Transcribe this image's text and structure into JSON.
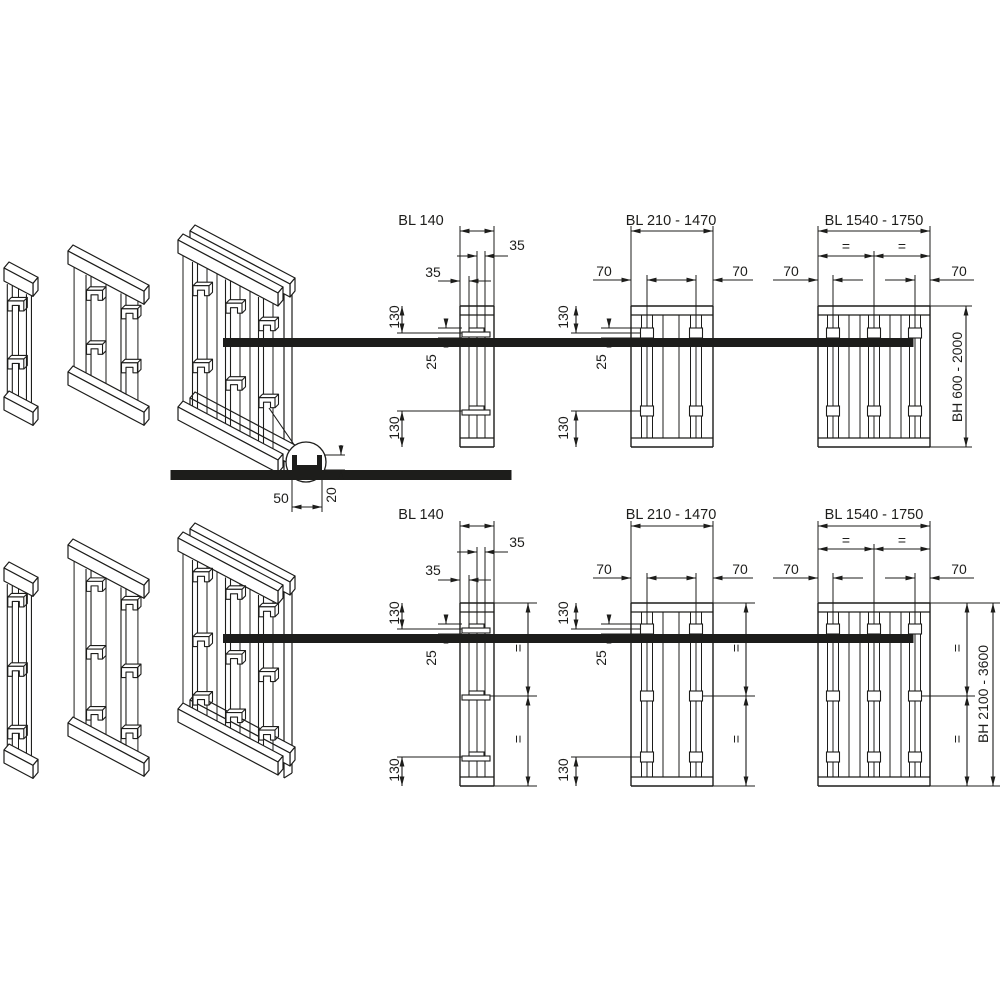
{
  "colors": {
    "line": "#1d1d1b",
    "background": "#ffffff"
  },
  "detail_callout": {
    "dim_width": "50",
    "dim_height": "20"
  },
  "rows": {
    "top": {
      "bl140": {
        "title": "BL 140",
        "dim_35_upper": "35",
        "dim_35_lower": "35",
        "dim_130_top": "130",
        "dim_25": "25",
        "dim_130_bottom": "130"
      },
      "bl210_1470": {
        "title": "BL 210 - 1470",
        "dim_70_left": "70",
        "dim_70_right": "70",
        "dim_130_top": "130",
        "dim_25": "25",
        "dim_130_bottom": "130"
      },
      "bl1540_1750": {
        "title": "BL 1540 - 1750",
        "dim_eq_left": "=",
        "dim_eq_right": "=",
        "dim_70_left": "70",
        "dim_70_right": "70",
        "dim_bh": "BH 600 - 2000"
      }
    },
    "bottom": {
      "bl140": {
        "title": "BL 140",
        "dim_35_upper": "35",
        "dim_35_lower": "35",
        "dim_130_top": "130",
        "dim_25": "25",
        "dim_130_bottom": "130",
        "dim_eq_upper": "=",
        "dim_eq_lower": "="
      },
      "bl210_1470": {
        "title": "BL 210 - 1470",
        "dim_70_left": "70",
        "dim_70_right": "70",
        "dim_130_top": "130",
        "dim_25": "25",
        "dim_130_bottom": "130",
        "dim_eq_upper": "=",
        "dim_eq_lower": "="
      },
      "bl1540_1750": {
        "title": "BL 1540 - 1750",
        "dim_eq_left": "=",
        "dim_eq_right": "=",
        "dim_70_left": "70",
        "dim_70_right": "70",
        "dim_eq_upper": "=",
        "dim_eq_lower": "=",
        "dim_bh": "BH 2100 - 3600"
      }
    }
  }
}
